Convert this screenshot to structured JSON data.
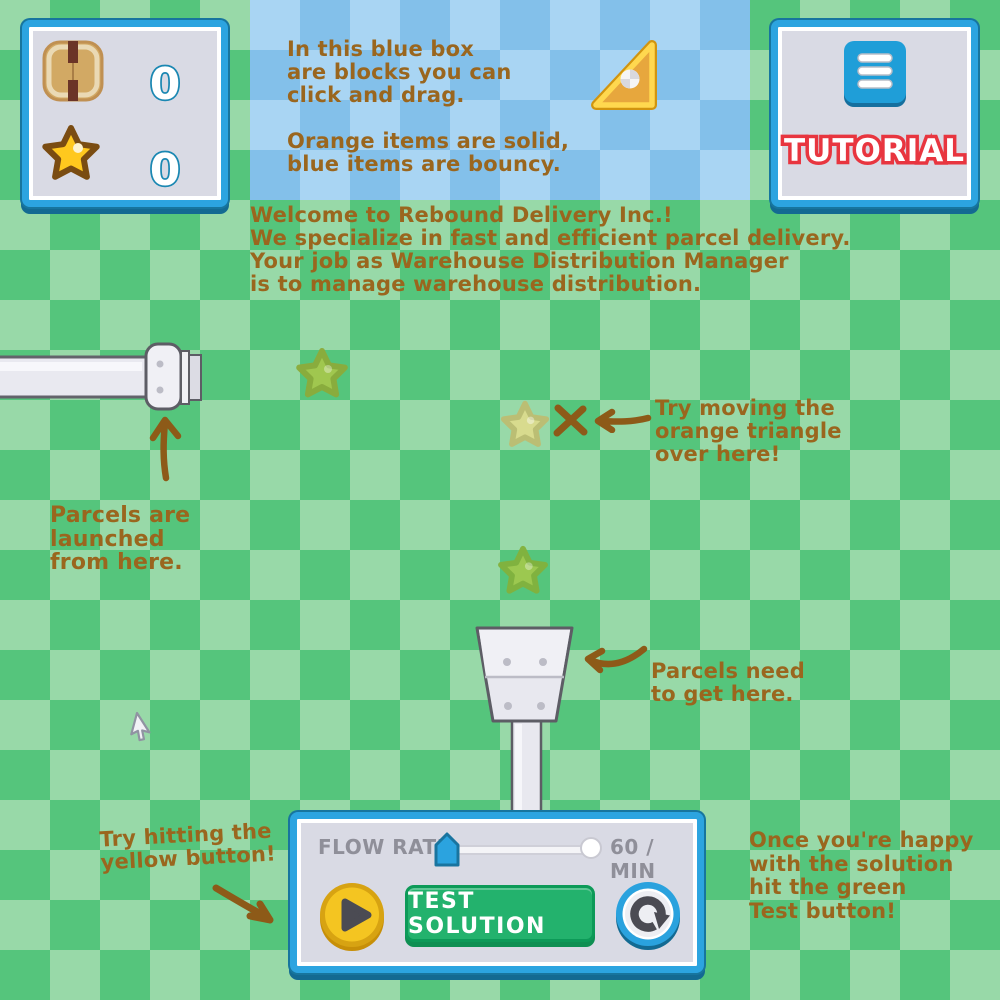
{
  "palette": {
    "bg_light": "#98d9a8",
    "bg_dark": "#55c57c",
    "tray_light": "#a9d5f3",
    "tray_dark": "#83c0ea",
    "panel_body": "#d9dae4",
    "panel_border_blue": "#2ca4e0",
    "note_brown": "#9a661e",
    "tutorial_red": "#e8353f",
    "count_teal": "#1a87b2",
    "button_gold": "#f4c521",
    "button_green": "#23b26d",
    "button_blue": "#2aa2de",
    "block_orange": "#e7a73d",
    "block_orange_rim": "#ffd84f",
    "ghost_star_green": "#a5c84d",
    "ghost_star_pale": "#dcdc8d",
    "machine_gray": "#e9e9f0",
    "control_text_gray": "#8f8f99"
  },
  "hud": {
    "counters": {
      "parcel_count": "0",
      "star_count": "0"
    },
    "tutorial": {
      "label": "TUTORIAL"
    }
  },
  "blue_box": {
    "text": "In this blue box\nare blocks you can\nclick and drag.\n\nOrange items are solid,\nblue items are bouncy."
  },
  "intro": {
    "text": "Welcome to Rebound Delivery Inc.!\nWe specialize in fast and efficient parcel delivery.\nYour job as Warehouse Distribution Manager\nis to manage warehouse distribution."
  },
  "notes": {
    "launcher": "Parcels are\nlaunched\nfrom here.",
    "triangle": "Try moving the\norange triangle\nover here!",
    "hopper": "Parcels need\nto get here.",
    "play": "Try hitting the\nyellow button!",
    "test": "Once you're happy\nwith the solution\nhit the green\nTest button!"
  },
  "controls": {
    "flow_rate_label": "FLOW RATE:",
    "flow_rate_value": "60 / MIN",
    "test_button_label": "TEST SOLUTION"
  }
}
